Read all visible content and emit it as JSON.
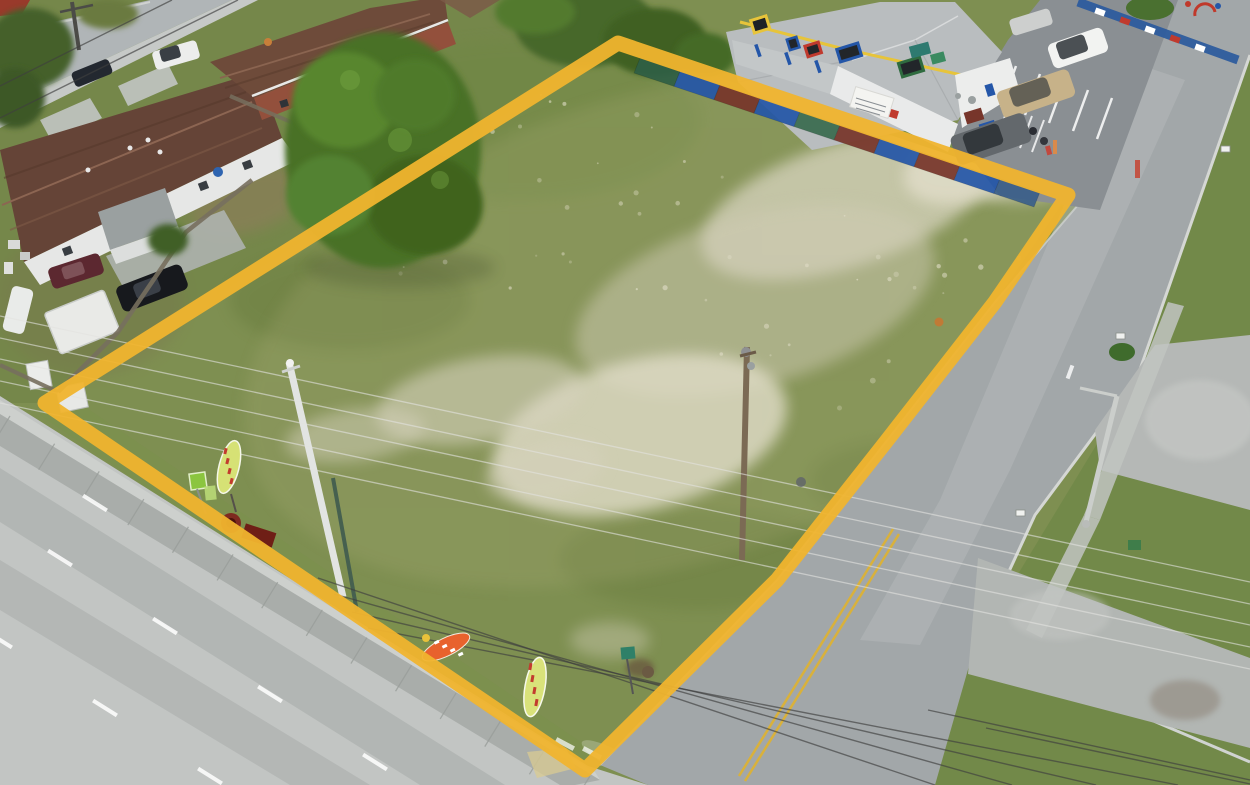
{
  "image": {
    "kind": "aerial-drone-photograph",
    "description": "Aerial view of a vacant corner lot outlined with a yellow property boundary, bordered by a main road (bottom-left), a side road (right), residential houses (top-left) and a colorful daycare building with parking (top-right).",
    "width": 1250,
    "height": 785
  },
  "palette": {
    "boundary_yellow": "#F0B42E",
    "lot_grass": "#7E8F51",
    "yard_grass": "#6E8245",
    "east_grass": "#648340",
    "daycare_grass": "#6F8F45",
    "sand": "#DCD8C4",
    "road_concrete": "#C2C5C3",
    "curb_band": "#A9ADAA",
    "back_walk": "#CDD0CD",
    "side_road_asphalt": "#A2A7A9",
    "parking_asphalt": "#8A8F93",
    "street_gray": "#B0B5B7",
    "sidewalk": "#C6C9C7",
    "roof_brown": "#654437",
    "roof_brown_2": "#6E4B3A",
    "brick_wall": "#93503C",
    "white_wall": "#E6E7E6",
    "daycare_roof": "#B9BDBF",
    "daycare_trim_yellow": "#E7C43A",
    "fence_wood": "#776F5E",
    "double_yellow": "#D9B13B",
    "wire_light": "#E3E3E0",
    "wire_dark": "#3F3F3F",
    "flag_orange": "#E8622D",
    "flag_yellowgreen": "#D6E175",
    "sign_green": "#8BC53F"
  },
  "boundary": {
    "points": "45,403 618,43 1068,195 995,302 885,443 777,580 585,770",
    "color": "#F0B42E",
    "stroke_width": 15,
    "opacity": 0.95
  },
  "inventory": {
    "feather_flags": 3,
    "utility_poles": 4,
    "parking_cars": 4,
    "residential_vehicles": 6,
    "people": 2,
    "mailboxes": 3
  },
  "scene": {
    "wires_light": [
      [
        0,
        316,
        1250,
        582
      ],
      [
        0,
        338,
        1250,
        604
      ],
      [
        0,
        359,
        1250,
        625
      ],
      [
        0,
        381,
        1250,
        647
      ],
      [
        0,
        403,
        1250,
        669
      ]
    ],
    "wires_dark": [
      [
        318,
        578,
        935,
        785
      ],
      [
        334,
        594,
        1012,
        785
      ],
      [
        352,
        612,
        1096,
        785
      ],
      [
        368,
        628,
        1178,
        785
      ],
      [
        928,
        710,
        1250,
        780
      ],
      [
        986,
        728,
        1250,
        784
      ],
      [
        0,
        86,
        172,
        0
      ],
      [
        0,
        118,
        238,
        0
      ]
    ],
    "lane_dashes": [
      [
        95,
        503
      ],
      [
        60,
        558
      ],
      [
        165,
        626
      ],
      [
        270,
        694
      ],
      [
        375,
        762
      ],
      [
        0,
        640
      ],
      [
        105,
        708
      ],
      [
        210,
        776
      ]
    ],
    "stop_marks": [
      [
        565,
        744
      ],
      [
        592,
        753
      ],
      [
        620,
        762
      ],
      [
        648,
        772
      ]
    ],
    "sidewalk_joints": {
      "count": 14,
      "x0": 10,
      "y0": 416,
      "x1": 590,
      "y1": 776
    },
    "fence_panels": {
      "x": 640,
      "y": 58,
      "dx": 40,
      "dy": 13.4,
      "drop": 15,
      "colors": [
        "#2F5F45",
        "#2456A8",
        "#77352A",
        "#2456A8",
        "#3A6B4F",
        "#77352A",
        "#2456A8",
        "#77352A",
        "#2456A8",
        "#3A5F8A"
      ]
    },
    "parking_stripes": {
      "x0": 992,
      "y0": 58,
      "step_x": 24,
      "step_y": 8,
      "vec_x": -15,
      "vec_y": 41,
      "count": 6
    },
    "parking_hatch": {
      "x0": 1008,
      "y0": 108,
      "step_x": 12,
      "step_y": 4,
      "vec_x": -12,
      "vec_y": 32,
      "count": 4
    },
    "speckles": {
      "count": 80,
      "seed": 7,
      "x_min": 300,
      "x_max": 1060,
      "slope": 0.34,
      "y_base": 120,
      "jitter": 240
    }
  }
}
